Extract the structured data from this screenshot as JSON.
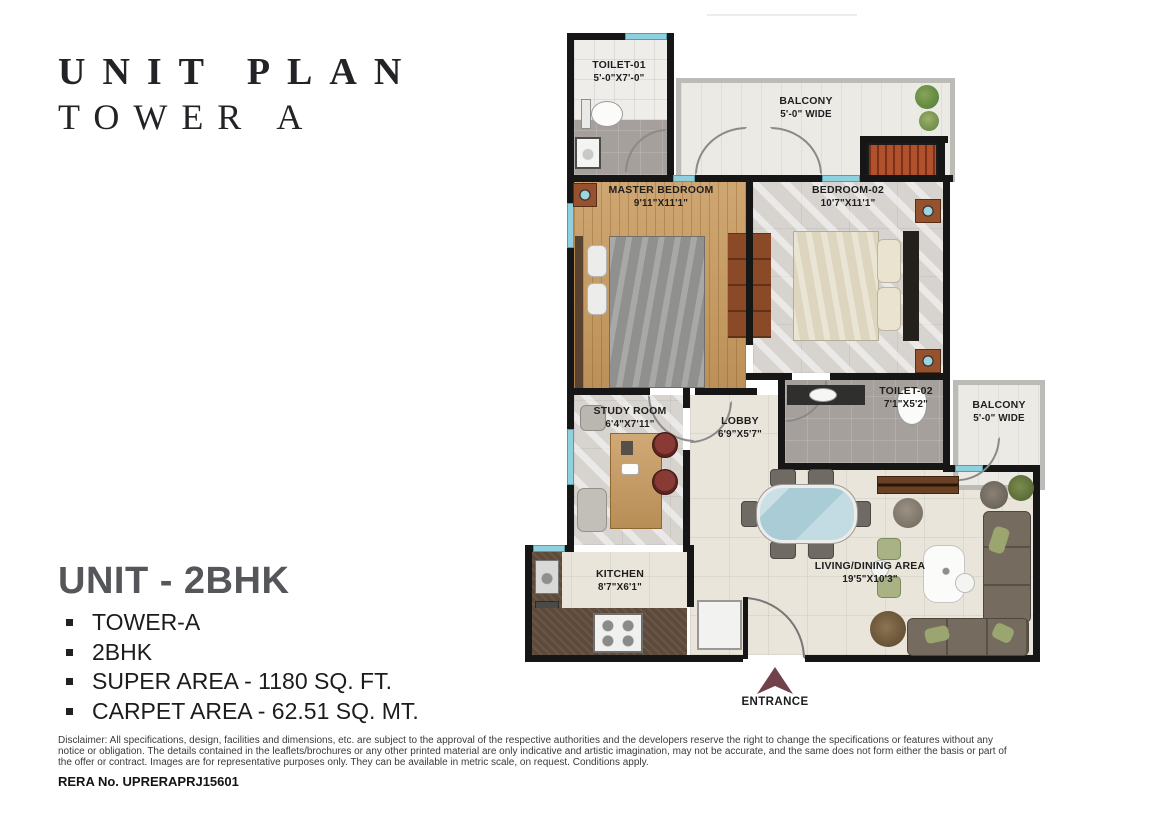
{
  "header": {
    "title_line1": "UNIT PLAN",
    "title_line2": "TOWER A"
  },
  "plan": {
    "rooms": {
      "toilet1": {
        "name": "TOILET-01",
        "dims": "5'-0\"X7'-0\""
      },
      "balcony_top": {
        "name": "BALCONY",
        "dims": "5'-0\" WIDE"
      },
      "master_bedroom": {
        "name": "MASTER BEDROOM",
        "dims": "9'11\"X11'1\""
      },
      "bedroom2": {
        "name": "BEDROOM-02",
        "dims": "10'7\"X11'1\""
      },
      "toilet2": {
        "name": "TOILET-02",
        "dims": "7'1\"X5'2\""
      },
      "balcony_right": {
        "name": "BALCONY",
        "dims": "5'-0\" WIDE"
      },
      "study": {
        "name": "STUDY ROOM",
        "dims": "6'4\"X7'11\""
      },
      "lobby": {
        "name": "LOBBY",
        "dims": "6'9\"X5'7\""
      },
      "kitchen": {
        "name": "KITCHEN",
        "dims": "8'7\"X6'1\""
      },
      "living": {
        "name": "LIVING/DINING AREA",
        "dims": "19'5\"X10'3\""
      }
    },
    "entrance_label": "ENTRANCE"
  },
  "unit_info": {
    "title": "UNIT - 2BHK",
    "bullets": [
      "TOWER-A",
      "2BHK",
      "SUPER AREA - 1180 SQ. FT.",
      "CARPET AREA - 62.51 SQ. MT."
    ]
  },
  "footer": {
    "disclaimer": "Disclaimer: All specifications, design, facilities and dimensions, etc. are subject to the approval of the respective authorities and the developers reserve the right to change the specifications or features without any notice or obligation. The details contained in the leaflets/brochures or any other printed material are only indicative and artistic imagination, may not be accurate, and the same does not form either the basis or part of the offer or contract. Images are for representative purposes only. They can be available in metric scale, on request. Conditions apply.",
    "rera": "RERA No. UPRERAPRJ15601"
  },
  "colors": {
    "wall": "#161616",
    "window": "#8ed0dd",
    "wood_floor": "#c89a5e",
    "marble_floor": "#d7d3cf",
    "tile_floor": "#eae5da",
    "entrance_arrow": "#714249",
    "accent_chair_red": "#7e3030",
    "wardrobe_orange": "#b0502c"
  }
}
